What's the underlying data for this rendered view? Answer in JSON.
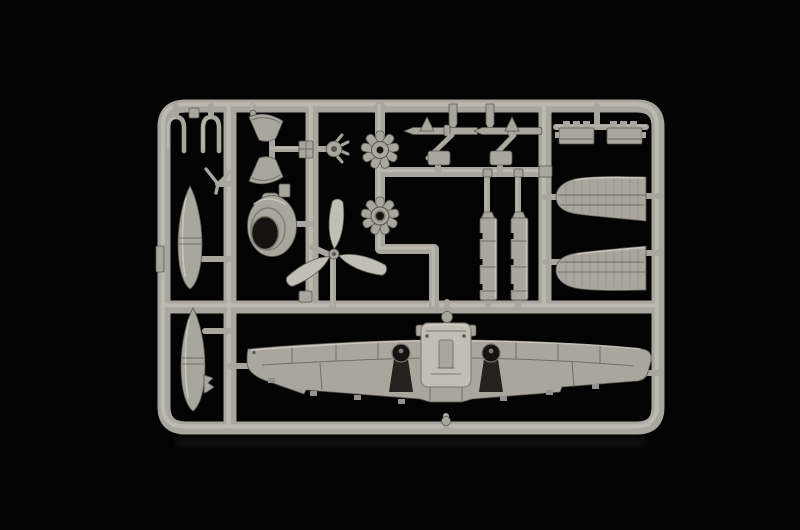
{
  "meta": {
    "description": "Photograph of a light-grey injection-moulded plastic model aircraft sprue (parts tree) on a black background"
  },
  "scene": {
    "palette": {
      "bg": "#030303",
      "p-hi": "#d3d0c7",
      "p-lite": "#c1beb5",
      "p-base": "#a9a69d",
      "p-mid": "#94918a",
      "p-sh": "#7b786f",
      "p-dark": "#5a5750",
      "hole": "#141311",
      "well": "#23221e"
    }
  },
  "parts": {
    "photo": "model kit sprue photograph",
    "frame": "sprue frame and runners",
    "fork_left": "landing gear fork (left)",
    "fork_right": "landing gear fork (right)",
    "wishbone": "V-shaped brace part",
    "tank_upper": "drop tank (upper)",
    "tank_lower": "drop tank (lower)",
    "funnel_upper": "intake funnel part (upper)",
    "funnel_lower": "intake funnel part (lower)",
    "cowling": "engine cowling ring",
    "hub": "pronged hub part",
    "engine_front": "radial engine face (upper)",
    "engine_rear": "radial engine face (lower)",
    "propeller": "three-blade propeller",
    "gear_leg_left": "landing gear leg and gun barrel (left)",
    "gear_leg_right": "landing gear leg and gun barrel (right)",
    "flap_left": "flap strip (left)",
    "flap_right": "flap strip (right)",
    "tailplane_left": "tailplane half (left)",
    "tailplane_right": "tailplane half (right)",
    "wing_panel_upper": "upper wing panel (top)",
    "wing_panel_lower": "upper wing panel (bottom)",
    "main_wing": "one-piece lower wing"
  }
}
